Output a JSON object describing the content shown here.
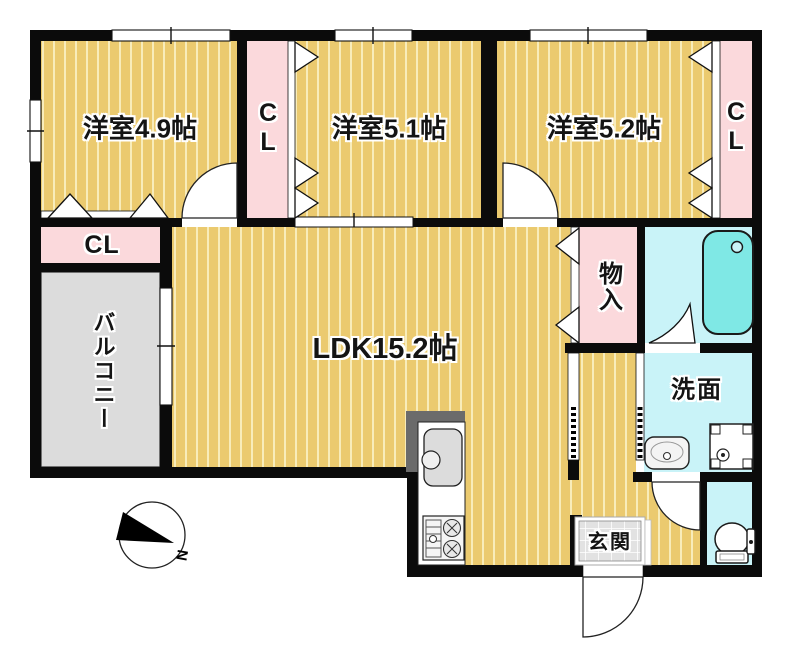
{
  "floorplan": {
    "labels": {
      "room_49": "洋室4.9帖",
      "room_51": "洋室5.1帖",
      "room_52": "洋室5.2帖",
      "ldk": "LDK15.2帖",
      "closet": "CL",
      "balcony": "バルコニー",
      "storage": "物入",
      "washroom": "洗面",
      "entrance": "玄関",
      "compass_north": "N"
    },
    "colors": {
      "wall": "#0b0b0b",
      "wood_floor": "#EBCA6F",
      "wood_floor_stripe": "#F8ECBA",
      "closet_pink": "#FBD9DC",
      "wet_area_cyan": "#C9F3F8",
      "bathtub_cyan": "#7FE8E5",
      "balcony_gray": "#DCDCDC",
      "entrance_tile_gray": "#E2E2E2"
    },
    "fixtures": [
      "bathtub-icon",
      "toilet-icon",
      "wash-basin-icon",
      "washing-machine-pan-icon",
      "kitchen-sink-icon",
      "gas-stove-icon",
      "compass-north-icon"
    ]
  }
}
